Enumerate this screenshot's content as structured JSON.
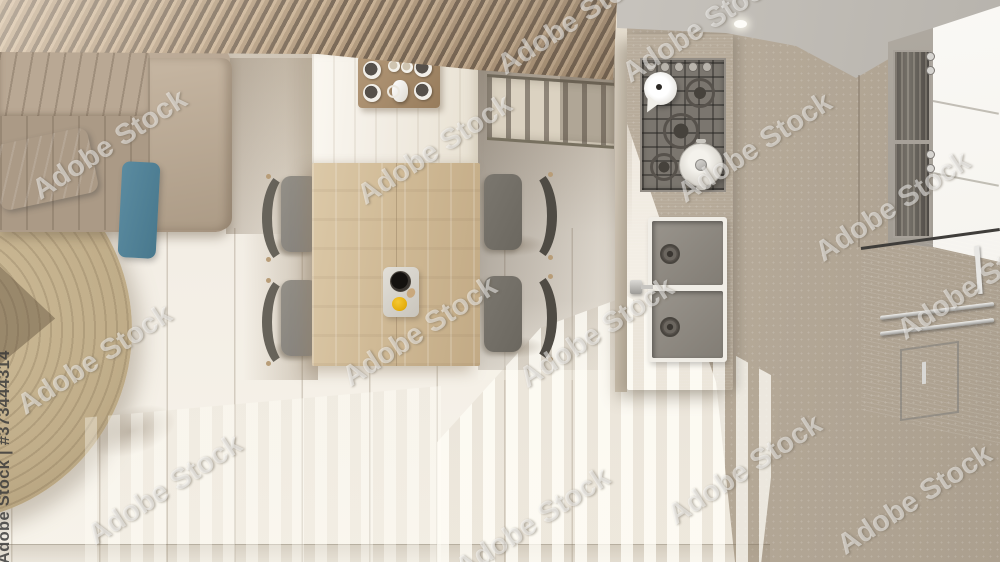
{
  "watermark": {
    "tile_text": "Adobe Stock",
    "id_label": "Adobe Stock | #373444314",
    "stock_id": "373444314"
  },
  "palette": {
    "slat_wood": "#ab9172",
    "slat_gap": "#6b5844",
    "sofa_base": "#b3a28f",
    "pillow_blue": "#5e8fa3",
    "pillow_blue_dark": "#48788d",
    "rug": "#c0ad89",
    "floor_light": "#f2ede4",
    "floor_beige": "#bdb1a0",
    "island_white": "#f3eee5",
    "table_wood": "#d0ba96",
    "chair_seat": "#938f87",
    "chair_back": "#67635a",
    "island_grey": "#a49e96",
    "hob": "#7b766f",
    "sink_basin": "#827d75",
    "steel": "#c3c2bf",
    "cabinet_white": "#f6f4ef",
    "glass_dark": "#5f5a54",
    "yellow": "#e3ac0b",
    "cup_black": "#211d19"
  },
  "scene": {
    "description": "Top view plan of a minimal kitchen and dining room: wood slat ceiling, sofa with blue pillows, round jute carpet, wooden dining table with four chairs and coffee trays, island with gas hob, kettle and pot, double sink island, tall white cabinets with built-in appliances, stainless steel unit, porcelain tiled floor with sunlight stripes."
  }
}
